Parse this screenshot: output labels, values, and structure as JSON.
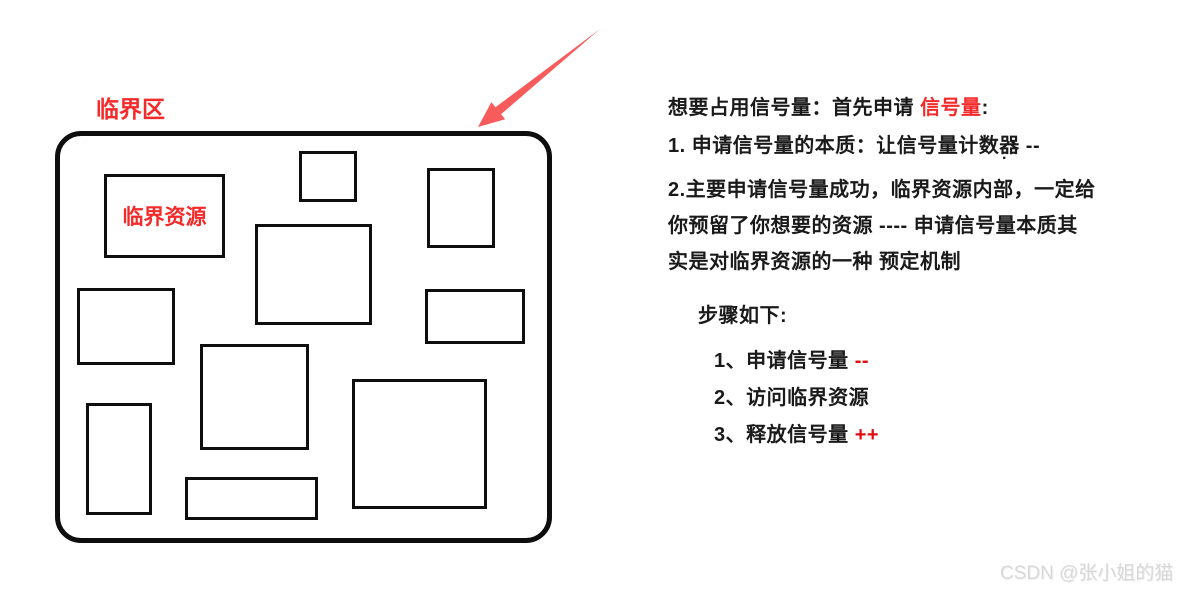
{
  "diagram": {
    "area_label": "临界区",
    "box": {
      "x": 55,
      "y": 131,
      "w": 497,
      "h": 412,
      "radius": 26
    },
    "rects": [
      {
        "x": 104,
        "y": 174,
        "w": 121,
        "h": 84,
        "label": "临界资源"
      },
      {
        "x": 299,
        "y": 151,
        "w": 58,
        "h": 51
      },
      {
        "x": 427,
        "y": 168,
        "w": 68,
        "h": 80
      },
      {
        "x": 255,
        "y": 224,
        "w": 117,
        "h": 101
      },
      {
        "x": 425,
        "y": 289,
        "w": 100,
        "h": 55
      },
      {
        "x": 77,
        "y": 288,
        "w": 98,
        "h": 77
      },
      {
        "x": 200,
        "y": 344,
        "w": 109,
        "h": 106
      },
      {
        "x": 352,
        "y": 379,
        "w": 135,
        "h": 130
      },
      {
        "x": 86,
        "y": 403,
        "w": 66,
        "h": 112
      },
      {
        "x": 185,
        "y": 477,
        "w": 133,
        "h": 43
      }
    ],
    "arrow": {
      "tail_x": 600,
      "tail_y": 29,
      "tip_x": 478,
      "tip_y": 127
    }
  },
  "notes": {
    "header": {
      "black1": "想要占用信号量：首先申请 ",
      "red": "信号量",
      "black2": ":"
    },
    "line1": "1. 申请信号量的本质：让信号量计数器 --",
    "stray_dot": ".",
    "para2_lines": [
      "2.主要申请信号量成功，临界资源内部，一定给",
      "你预留了你想要的资源 ---- 申请信号量本质其",
      "实是对临界资源的一种 预定机制"
    ]
  },
  "steps": {
    "header": "步骤如下:",
    "items": [
      {
        "text": "1、申请信号量 ",
        "mark": "--"
      },
      {
        "text": "2、访问临界资源",
        "mark": ""
      },
      {
        "text": "3、释放信号量 ",
        "mark": "++"
      }
    ]
  },
  "watermark": "CSDN @张小姐的猫",
  "colors": {
    "text": "#1a1a1a",
    "red_label": "#f52a2a",
    "red_mark": "#e20c0c",
    "arrow": "#f75b5b",
    "stroke": "#0e0e0e",
    "watermark": "#d8d8d8"
  }
}
